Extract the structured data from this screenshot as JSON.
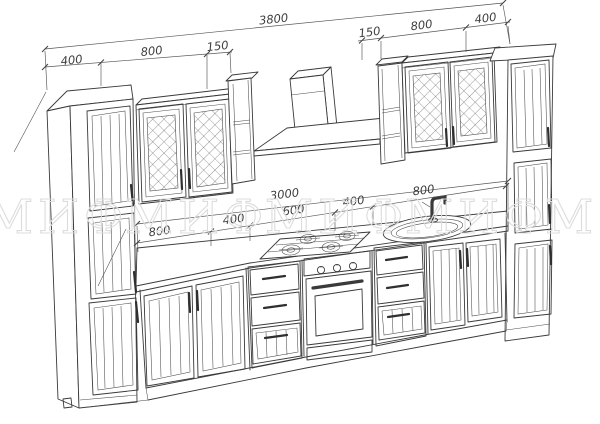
{
  "watermark": {
    "text": "МИФ"
  },
  "dimensions": {
    "overall_width": "3800",
    "top_left_chain": [
      "400",
      "800",
      "150"
    ],
    "top_right_chain": [
      "150",
      "800",
      "400"
    ],
    "base_overall": "3000",
    "base_chain": [
      "800",
      "400",
      "600",
      "400",
      "800"
    ]
  },
  "colors": {
    "line": "#3a3a3a",
    "dimension_text": "#3f3f3f",
    "watermark": "#dcdcdc",
    "background": "#ffffff"
  }
}
